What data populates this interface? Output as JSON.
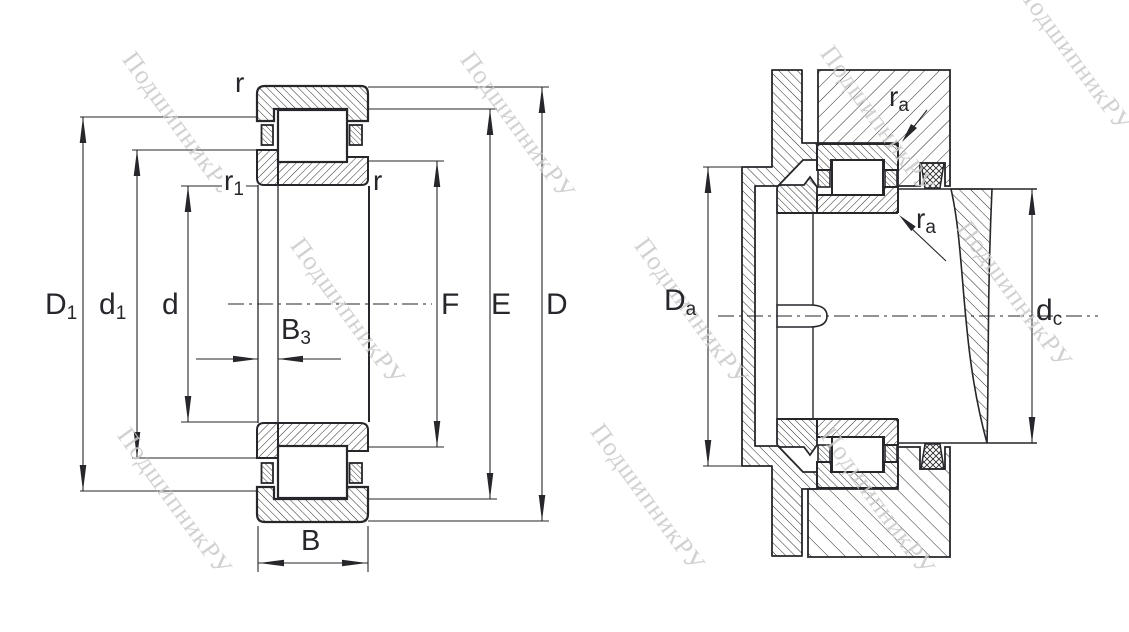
{
  "watermark": {
    "text": "ПодшипникРУ",
    "color": "#c9c9c9"
  },
  "colors": {
    "line": "#26262b",
    "hatch": "#2b2b2b",
    "background": "#ffffff"
  },
  "labels": {
    "r_outer_top": {
      "main": "r",
      "sub": ""
    },
    "r1": {
      "main": "r",
      "sub": "1"
    },
    "r_inner_right": {
      "main": "r",
      "sub": ""
    },
    "D1": {
      "main": "D",
      "sub": "1"
    },
    "d1": {
      "main": "d",
      "sub": "1"
    },
    "d": {
      "main": "d",
      "sub": ""
    },
    "B3": {
      "main": "B",
      "sub": "3"
    },
    "B": {
      "main": "B",
      "sub": ""
    },
    "F": {
      "main": "F",
      "sub": ""
    },
    "E": {
      "main": "E",
      "sub": ""
    },
    "D": {
      "main": "D",
      "sub": ""
    },
    "Da": {
      "main": "D",
      "sub": "a"
    },
    "dc": {
      "main": "d",
      "sub": "c"
    },
    "ra_top": {
      "main": "r",
      "sub": "a"
    },
    "ra_bottom": {
      "main": "r",
      "sub": "a"
    }
  }
}
